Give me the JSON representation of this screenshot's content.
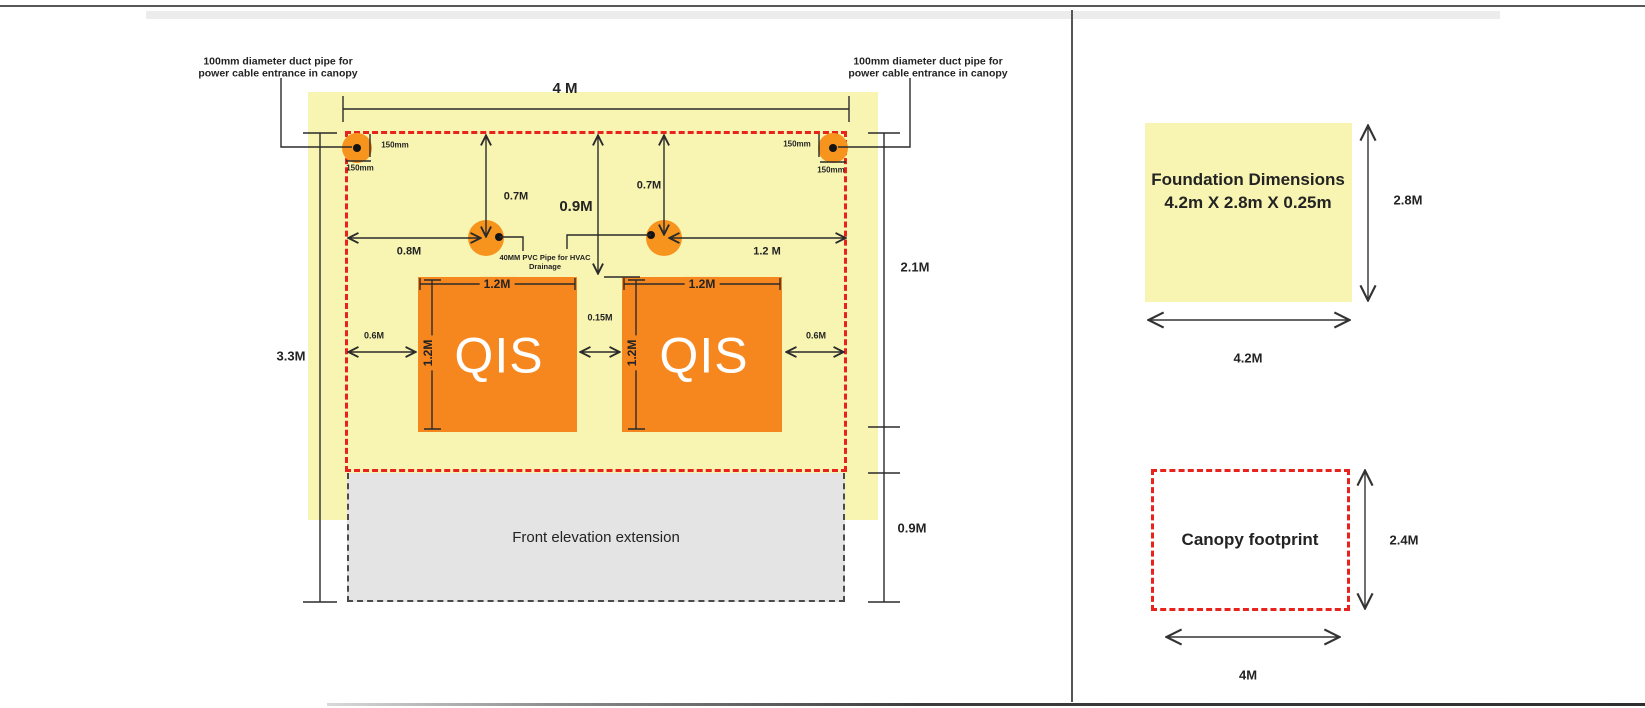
{
  "colors": {
    "plan_yellow": "#f8f5b2",
    "unit_orange": "#f6871f",
    "pipe_orange": "#f7941d",
    "dashed_red": "#e8221c",
    "extension_gray": "#e4e4e4",
    "line": "#2b2b2b"
  },
  "plan": {
    "duct_label_left": {
      "line1": "100mm diameter duct pipe for",
      "line2": "power cable entrance in canopy"
    },
    "duct_label_right": {
      "line1": "100mm diameter duct pipe for",
      "line2": "power cable entrance in canopy"
    },
    "pvc_label": {
      "line1": "40MM PVC Pipe for HVAC",
      "line2": "Drainage"
    },
    "qis_left_label": "QIS",
    "qis_right_label": "QIS",
    "extension_label": "Front elevation extension",
    "dims": {
      "top_width": "4 M",
      "left_height": "3.3M",
      "right_upper": "2.1M",
      "right_lower": "0.9M",
      "duct_left_vertical": "150mm",
      "duct_left_horizontal": "150mm",
      "duct_right_vertical": "150mm",
      "duct_right_horizontal": "150mm",
      "pipe_left_from_top": "0.7M",
      "pipe_right_from_top": "0.7M",
      "center_from_top": "0.9M",
      "pipe_left_from_edge": "0.8M",
      "pipe_right_from_edge": "1.2 M",
      "qis_left_width": "1.2M",
      "qis_left_height": "1.2M",
      "qis_right_width": "1.2M",
      "qis_right_height": "1.2M",
      "qis_gap": "0.15M",
      "clearance_left": "0.6M",
      "clearance_right": "0.6M"
    }
  },
  "side_panel": {
    "foundation": {
      "title": "Foundation Dimensions",
      "subtitle": "4.2m X 2.8m X 0.25m",
      "height_dim": "2.8M",
      "width_dim": "4.2M"
    },
    "canopy": {
      "label": "Canopy footprint",
      "height_dim": "2.4M",
      "width_dim": "4M"
    }
  }
}
